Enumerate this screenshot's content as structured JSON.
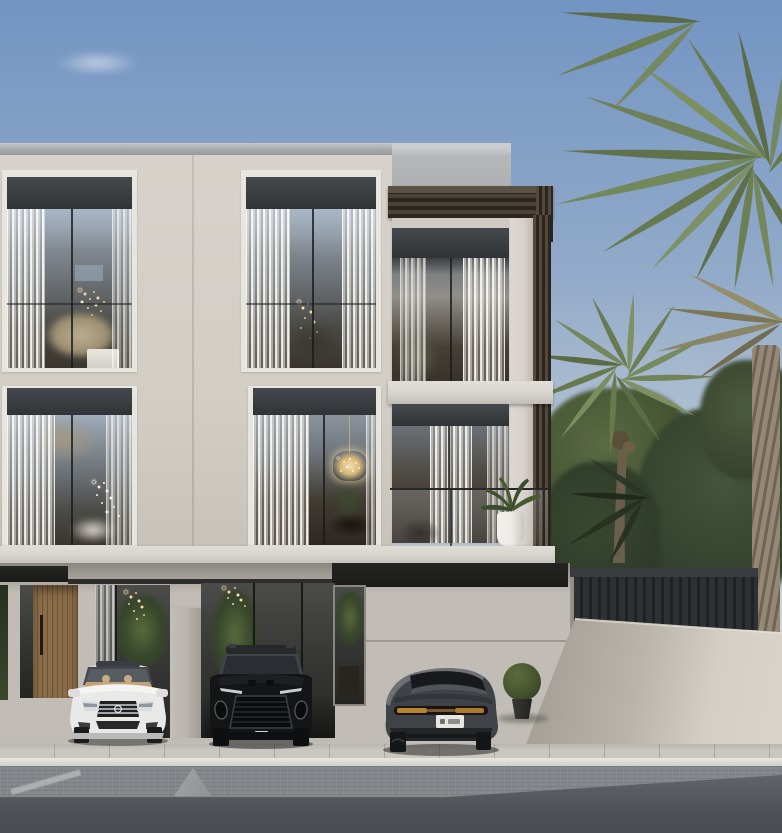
{
  "scene": {
    "setting": "Daylight exterior rendering of a modern three-storey villa with ground-level parking, palm trees and a paved street",
    "sky": "clear blue sky with one faint cloud wisp",
    "building": {
      "floors_visible": 3,
      "left_block": {
        "window_bays": 4,
        "features": [
          "dark recessed window headers",
          "sheer white curtains",
          "interior string lights",
          "crystal chandelier",
          "dried palm arrangement",
          "white furniture"
        ]
      },
      "right_block": {
        "features": [
          "rooftop pergola with dark slats",
          "recessed balcony",
          "glass balcony railing",
          "timber louver edge",
          "white potted balcony plant"
        ]
      },
      "ground_floor": {
        "features": [
          "timber slat entrance door",
          "glass lobby walls",
          "pendant light clusters",
          "concrete pillar",
          "covered parking bays",
          "tall glass slot window"
        ]
      }
    },
    "vehicles": [
      {
        "name": "white-luxury-sedan",
        "view": "front",
        "body_color": "#e9e9e7",
        "interior": "tan"
      },
      {
        "name": "black-luxury-suv",
        "view": "front",
        "body_color": "#141517",
        "grille": "large mesh"
      },
      {
        "name": "graphite-fastback-sedan",
        "view": "rear",
        "body_color": "#3f4347",
        "taillight_color": "#b5852f",
        "license_plate_color": "#e8e6e1"
      }
    ],
    "vegetation": [
      "tall palm tree at right edge with large crown",
      "date palm with round crown and slender trunk",
      "dried palm fronds upper right",
      "dense dark green trees",
      "spherical topiary shrub in dark pot",
      "hedge sliver at far left"
    ],
    "site": [
      "dark metal slat fence on boundary wall",
      "sloped light concrete boundary wall",
      "light concrete driveway",
      "paved sidewalk with white curb",
      "grey block-paved road with ramp wedges"
    ]
  },
  "colors": {
    "sky_top": "#7394c3",
    "sky_mid": "#93abc9",
    "sky_low": "#c2cdd6",
    "facade": "#d7d2cb",
    "facade_shade": "#c6c1b9",
    "parapet": "#a7a8a9",
    "frame": "#e8e5df",
    "header_dark": "#45484c",
    "header_darker": "#313437",
    "glass_top": "#9fadbc",
    "glass_mid": "#6f757b",
    "interior_dark": "#3a352e",
    "curtain": "#efece7",
    "setback_gray": "#b7b8b9",
    "pergola": "#3e362d",
    "louver_gap": "#2b251f",
    "slab": "#dad6d0",
    "canopy": "#242422",
    "gf_wall": "#c1bdb6",
    "door_wood": "#8a6c49",
    "door_wood_dark": "#6d5437",
    "pillar": "#b7b3ac",
    "glass_dark": "#373835",
    "pendant_glow": "#ffd9a0",
    "chandelier_gold": "#d8b878",
    "fence": "#2e3133",
    "fence_rail": "#393c3f",
    "wall_light": "#d4cfc4",
    "wall_shadow": "#a5a198",
    "trunk": "#958976",
    "trunk_dark": "#6f6455",
    "tree_dark": "#2f3b29",
    "tree_mid": "#46543a",
    "palm_green": "#697b4e",
    "palm_light": "#87976a",
    "palm_dry": "#807a5c",
    "floor": "#c8c5bf",
    "driveway": "#d6d3cc",
    "sidewalk": "#cac7c1",
    "curb": "#e9e7e2",
    "road_upper": "#84878b",
    "road_lower": "#51555a",
    "road_edge": "#8a877c",
    "ramp": "#a3a5a8",
    "car_white": "#e9e9e7",
    "car_black": "#141517",
    "car_gray": "#3f4347",
    "taillight": "#b5852f",
    "plate": "#e8e6e1",
    "topiary": "#46542f",
    "pot_dark": "#2c2b29",
    "pot_white": "#edebe6"
  }
}
